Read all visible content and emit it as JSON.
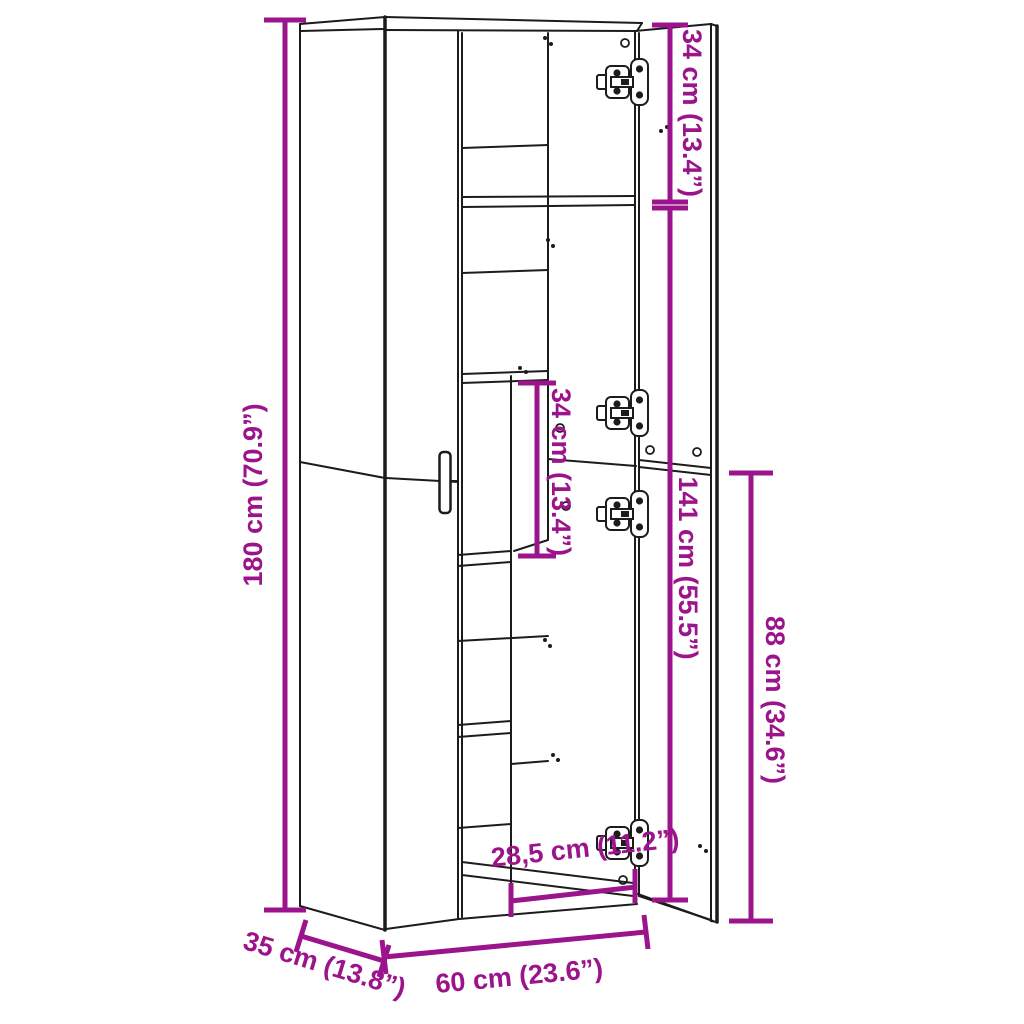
{
  "page": {
    "background": "#FFFFFF"
  },
  "diagram": {
    "title": "Tall cabinet dimension drawing",
    "accent_color": "#9C148C",
    "line_color": "#1C1C1C",
    "dimensions": {
      "height": {
        "label": "180 cm (70.9”)",
        "value_cm": "180",
        "value_in": "70.9"
      },
      "top_compartment": {
        "label": "34 cm (13.4”)",
        "value_cm": "34",
        "value_in": "13.4"
      },
      "lower_doors": {
        "label": "141 cm (55.5”)",
        "value_cm": "141",
        "value_in": "55.5"
      },
      "right_lower_door": {
        "label": "88 cm (34.6”)",
        "value_cm": "88",
        "value_in": "34.6"
      },
      "shelf_spacing": {
        "label": "34 cm (13.4”)",
        "value_cm": "34",
        "value_in": "13.4"
      },
      "inner_width": {
        "label": "28,5 cm (11.2”)",
        "value_cm": "28,5",
        "value_in": "11.2"
      },
      "width": {
        "label": "60 cm (23.6”)",
        "value_cm": "60",
        "value_in": "23.6"
      },
      "depth": {
        "label": "35 cm (13.8”)",
        "value_cm": "35",
        "value_in": "13.8"
      }
    }
  }
}
